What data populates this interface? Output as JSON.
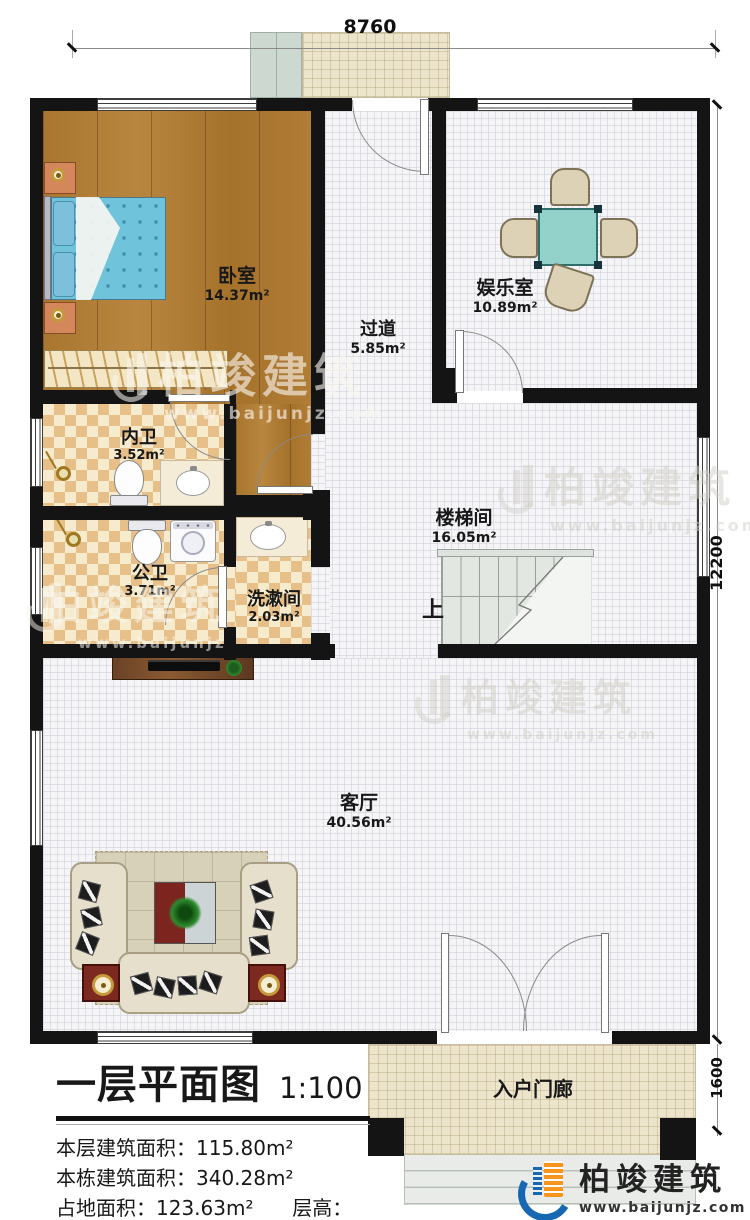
{
  "dimensions": {
    "top_width": "8760",
    "main_height": "12200",
    "porch_height": "1600"
  },
  "rooms": [
    {
      "name": "卧室",
      "area": "14.37m²"
    },
    {
      "name": "过道",
      "area": "5.85m²"
    },
    {
      "name": "娱乐室",
      "area": "10.89m²"
    },
    {
      "name": "内卫",
      "area": "3.52m²"
    },
    {
      "name": "公卫",
      "area": "3.71m²"
    },
    {
      "name": "洗漱间",
      "area": "2.03m²"
    },
    {
      "name": "楼梯间",
      "area": "16.05m²"
    },
    {
      "name": "客厅",
      "area": "40.56m²"
    },
    {
      "name": "入户门廊",
      "area": ""
    }
  ],
  "stairs": {
    "up_label": "上"
  },
  "title_block": {
    "title": "一层平面图",
    "scale": "1:100",
    "stats": [
      {
        "label": "本层建筑面积：",
        "value": "115.80m²"
      },
      {
        "label": "本栋建筑面积：",
        "value": "340.28m²"
      },
      {
        "label": "占地面积：",
        "value": "123.63m²"
      },
      {
        "label": "层高：",
        "value": "3.6m"
      }
    ]
  },
  "brand": {
    "name": "柏竣建筑",
    "url": "www.baijunjz.com"
  },
  "colors": {
    "wall": "#141414",
    "wood": "#a9762f",
    "checker_dark": "#e7c089",
    "checker_light": "#f6ebcd",
    "grid_floor": "#f5f5f7",
    "porch": "#ece4cb",
    "table_teal": "#93d2cb",
    "bed_blue": "#6fc3da",
    "logo_blue": "#1767b3",
    "logo_orange": "#f7941e"
  }
}
